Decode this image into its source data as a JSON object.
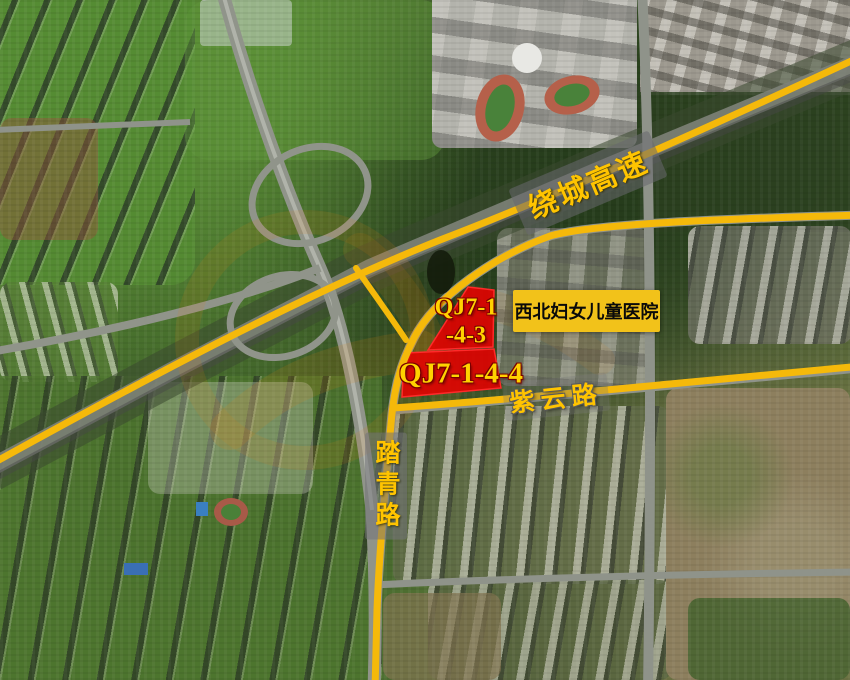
{
  "map": {
    "type": "satellite-annotated",
    "highway_label": "绕城高速",
    "road_label_ziyun": "紫云路",
    "road_label_taqing": "踏青路",
    "hospital_label": "西北妇女儿童医院",
    "parcel_1": {
      "name_line1": "QJ7-1",
      "name_line2": "-4-3"
    },
    "parcel_2": {
      "name": "QJ7-1-4-4"
    },
    "colors": {
      "road_highlight_yellow": "#f5b90a",
      "parcel_red": "#e60000",
      "label_text_yellow": "#ffc400",
      "hospital_box_yellow": "#f2c21a"
    }
  }
}
